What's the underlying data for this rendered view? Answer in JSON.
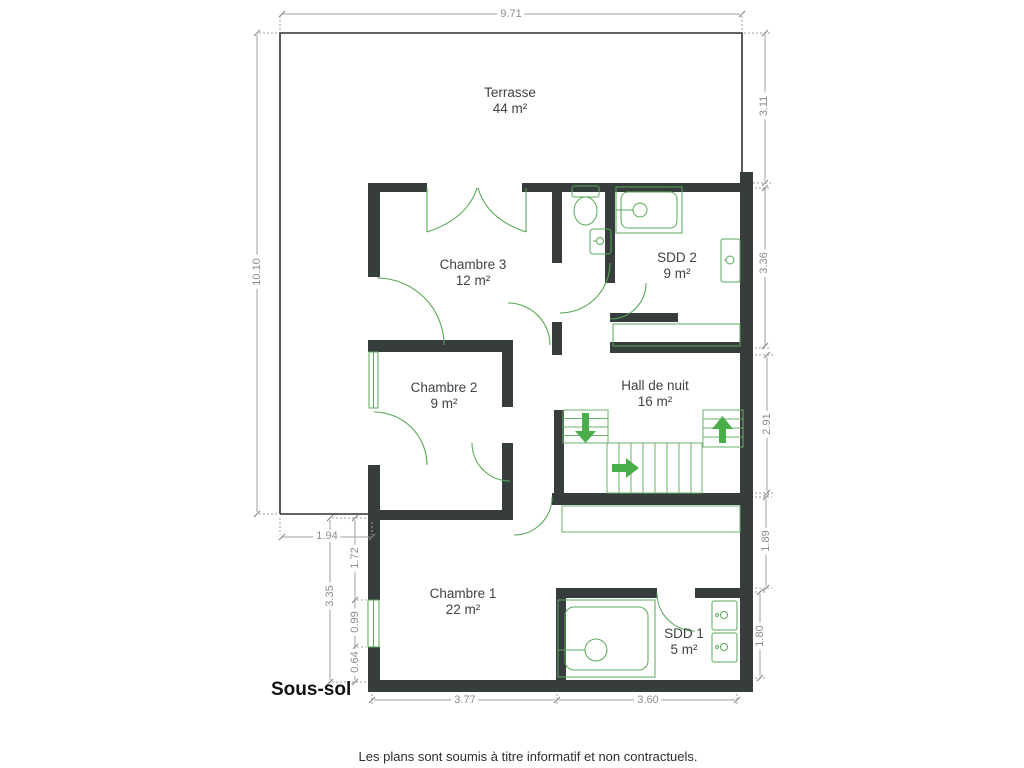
{
  "floor_label": "Sous-sol",
  "disclaimer": "Les plans sont soumis à titre informatif et non contractuels.",
  "rooms": {
    "terrasse": {
      "name": "Terrasse",
      "area": "44 m²"
    },
    "chambre3": {
      "name": "Chambre 3",
      "area": "12 m²"
    },
    "sdd2": {
      "name": "SDD 2",
      "area": "9 m²"
    },
    "chambre2": {
      "name": "Chambre 2",
      "area": "9 m²"
    },
    "hall": {
      "name": "Hall de nuit",
      "area": "16 m²"
    },
    "chambre1": {
      "name": "Chambre 1",
      "area": "22 m²"
    },
    "sdd1": {
      "name": "SDD 1",
      "area": "5 m²"
    }
  },
  "dimensions": {
    "terrace_width": "9.71",
    "terrace_height": "10.10",
    "right_top": "3.11",
    "sdd2_height": "3.36",
    "hall_height": "2.91",
    "right_mid": "1.89",
    "sdd1_height": "1.80",
    "terrace_left_strip": "1.94",
    "c1_left_total": "3.35",
    "c1_left_upper": "1.72",
    "c1_window": "0.99",
    "c1_left_lower": "0.64",
    "bottom_left": "3.77",
    "bottom_right": "3.60"
  },
  "colors": {
    "wall": "#373c3d",
    "outline": "#2e3233",
    "fixture_green": "#58a758",
    "arrow_green": "#4aae4a",
    "dim_gray": "#9f9f9f",
    "label_gray": "#3e4347"
  }
}
